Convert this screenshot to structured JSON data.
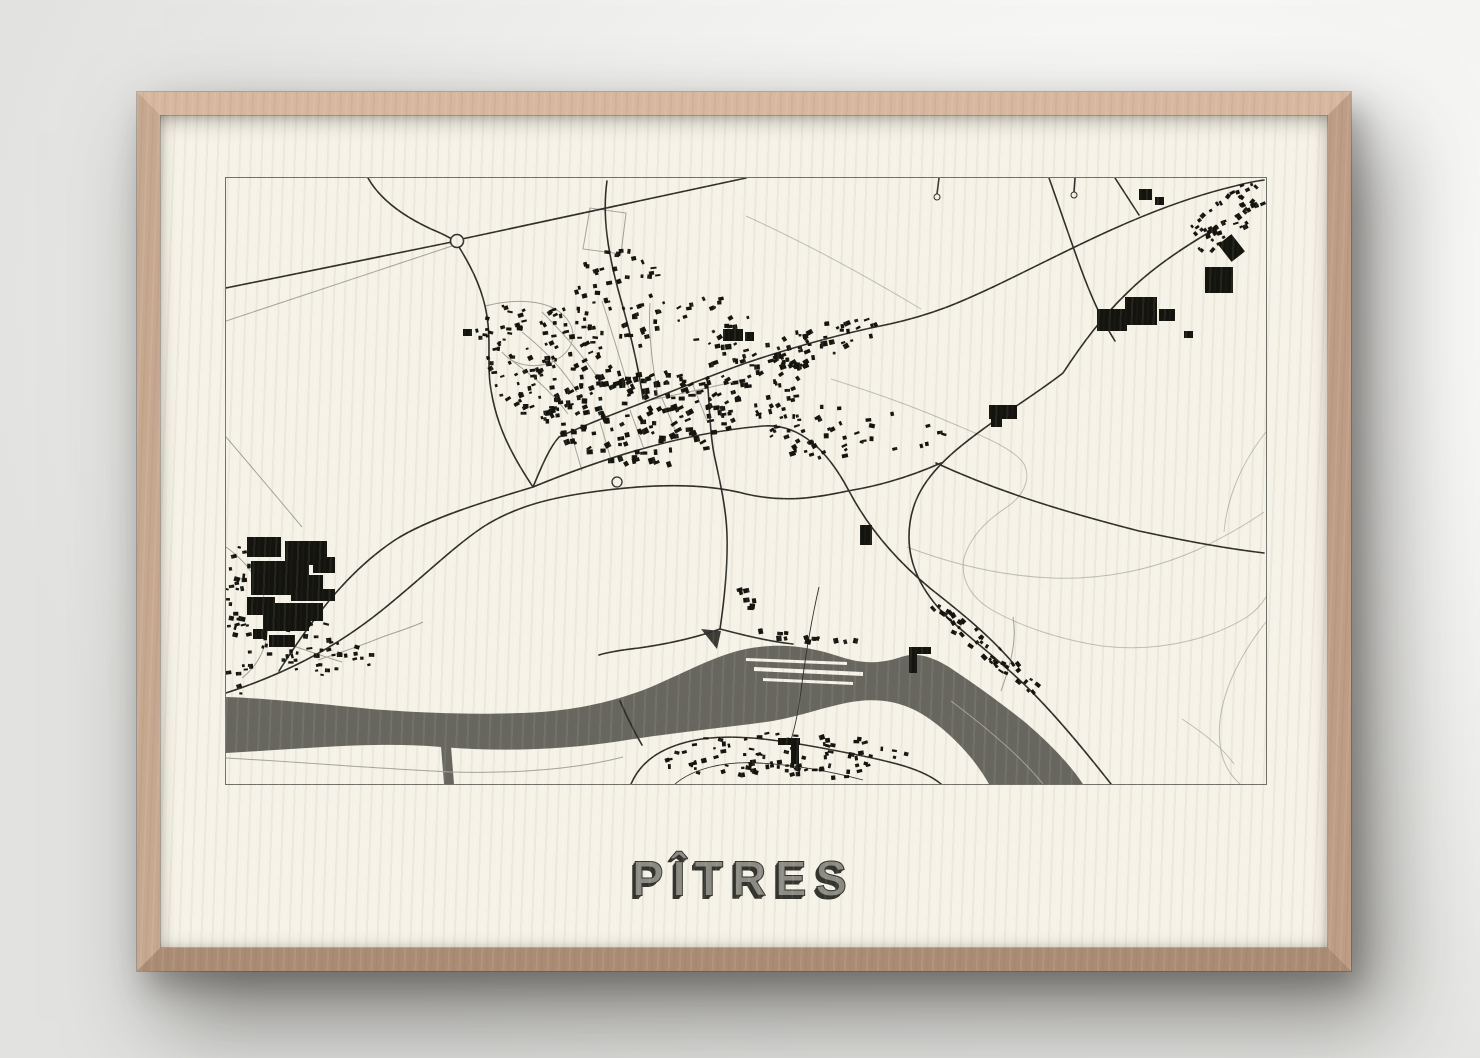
{
  "wall": {
    "center": "#ffffff",
    "mid": "#f1f1ef",
    "edge": "#e2e2e0"
  },
  "frame": {
    "wood_top": "#d6b79f",
    "wood_left": "#c6a88f",
    "wood_right": "#bd9d85",
    "wood_bottom": "#aa8c74"
  },
  "poster": {
    "background": "#f5f2e7",
    "title": "PÎTRES",
    "title_fill": "#8c8c85",
    "title_outline": "#34342f",
    "title_shadow": "#34342f"
  },
  "map": {
    "viewBox": "225 177 1040 606",
    "land_color": "#f5f2e7",
    "water_color": "#67675f",
    "border_color": "#70706a",
    "road_major_color": "#2e2e29",
    "road_minor_color": "#a3a399",
    "terrain_color": "#bdbdb2",
    "building_color": "#14140f",
    "structure_color": "#3b3b36",
    "water": {
      "main": "M225,696 C260,697 310,702 370,708 C430,713 490,714 540,711 C580,708 615,700 650,686 C685,671 715,654 745,648 C775,642 805,644 840,656 C862,663 880,663 900,656 C915,651 930,655 948,666 C975,684 1000,702 1025,722 C1048,742 1068,762 1082,783 L988,783 C975,760 955,737 930,719 C908,703 885,697 858,700 C830,703 800,716 765,721 C720,727 670,732 620,740 C560,749 500,751 440,746 C375,740 300,748 225,752 Z",
      "canal": "M439,733 L449,733 L453,783 L443,783 Z",
      "wedge": "M700,628 L720,630 L716,648 Z",
      "islands": [
        "M745,657 L846,661 L846,664 L745,660 Z",
        "M753,666 L862,671 L862,675 L753,670 Z",
        "M762,677 L852,681 L852,684 L762,680 Z"
      ]
    },
    "roads_major": [
      "M225,287 L451,241",
      "M461,238 L745,177",
      "M367,177 C380,200 404,216 430,228 C442,233 448,236 452,239",
      "M458,246 C469,264 479,283 484,305 C491,335 486,358 489,382 C492,406 499,428 510,449 C517,463 524,474 532,486",
      "M278,670 C318,607 352,567 394,539 C428,517 492,498 532,486",
      "M532,486 C542,462 549,446 558,436 C590,421 626,408 654,397 C684,385 714,373 745,362 C792,346 844,332 884,324 C932,314 962,300 992,286",
      "M992,286 C1034,266 1072,246 1110,229 C1152,210 1196,194 1234,185 C1245,182 1256,180 1263,179",
      "M606,180 C601,215 607,252 618,292 C628,327 637,362 642,398",
      "M706,378 C709,402 708,427 713,453 C719,481 725,506 726,533 C727,566 723,601 719,628",
      "M719,628 C694,637 666,643 638,647 C620,649 608,651 598,654",
      "M719,628 C742,634 766,640 792,643",
      "M1207,232 C1180,248 1150,268 1126,292 C1101,316 1081,343 1062,372 C1030,397 988,421 954,450 C924,476 908,501 908,536 C908,566 923,593 946,616 C971,639 1001,661 1029,689 C1051,711 1081,746 1110,783",
      "M935,462 C1000,492 1068,512 1138,530 C1184,540 1228,548 1263,552",
      "M1048,177 C1058,205 1068,235 1080,268 C1090,295 1100,318 1114,340",
      "M1114,177 L1138,214",
      "M938,177 L936,193",
      "M1074,177 L1073,191",
      "M630,783 C640,760 660,747 690,740 C732,730 792,741 852,753 C892,761 922,768 940,783",
      "M641,744 C633,730 625,714 619,700",
      "M532,486 C600,458 680,432 762,425 C800,422 828,452 848,490 C868,528 896,560 930,588 C958,610 988,634 1012,662",
      "M225,692 C280,674 330,650 380,610 C420,578 452,546 482,526 C512,507 544,498 584,492 C644,483 700,481 745,493 C792,504 830,493 852,489 C892,482 922,470 940,462"
    ],
    "roads_thin": [
      "M818,586 C812,612 806,645 801,682 C798,708 794,726 790,739",
      "M674,783 C692,768 722,760 757,762 C797,764 832,771 862,779"
    ],
    "roads_minor": [
      "M225,320 L451,245",
      "M484,305 C520,296 552,300 566,318 C578,334 571,352 551,361 C531,369 511,363 501,351",
      "M582,248 L589,207 L625,212 L620,253 Z",
      "M570,432 L581,470",
      "M599,421 L611,462",
      "M629,409 L643,448",
      "M661,397 L677,436",
      "M692,384 L706,420",
      "M601,300 C611,331 620,361 629,391",
      "M657,395 C651,361 647,331 649,302",
      "M521,331 C541,347 561,366 576,391",
      "M506,356 C530,373 552,392 567,413",
      "M541,311 C561,331 581,353 596,376",
      "M317,659 C342,651 364,643 384,635 C402,629 414,625 422,621",
      "M281,641 C301,648 321,655 341,661",
      "M225,546 C249,563 263,586 267,613 C269,641 259,663 241,677",
      "M225,436 C255,471 281,502 301,526",
      "M225,757 C300,761 380,768 450,771 C520,773 580,767 622,756",
      "M950,700 C990,730 1022,758 1042,783",
      "M1000,690 C1010,662 1016,640 1012,616",
      "M644,400 C676,394 710,386 745,378"
    ],
    "terrain": [
      "M830,378 C868,390 906,403 941,418 C976,433 1012,446 1023,463 C1031,479 1021,496 1006,506 C986,519 969,536 963,557 C959,577 969,596 991,609 C1021,626 1061,639 1101,645 C1151,651 1206,641 1246,616 C1256,609 1262,601 1265,596",
      "M906,546 C951,563 1001,575 1051,577 C1101,579 1151,569 1196,549 C1221,537 1246,523 1263,511",
      "M1265,431 C1241,461 1226,496 1223,531",
      "M1265,621 C1241,651 1223,686 1219,719 C1216,749 1223,769 1239,783",
      "M1181,718 C1201,731 1221,746 1233,763",
      "M745,215 C800,240 860,272 920,308"
    ],
    "circles": [
      {
        "x": 456,
        "y": 240,
        "r": 6.5,
        "sw": 1.6
      },
      {
        "x": 616,
        "y": 481,
        "r": 5,
        "sw": 1.3
      },
      {
        "x": 936,
        "y": 196,
        "r": 3,
        "sw": 1
      },
      {
        "x": 1073,
        "y": 194,
        "r": 3,
        "sw": 1
      }
    ],
    "large_buildings": [
      [
        246,
        536,
        34,
        20,
        0
      ],
      [
        284,
        540,
        42,
        24,
        0
      ],
      [
        250,
        560,
        58,
        34,
        0
      ],
      [
        290,
        574,
        32,
        26,
        0
      ],
      [
        312,
        556,
        22,
        16,
        0
      ],
      [
        246,
        596,
        28,
        18,
        0
      ],
      [
        262,
        602,
        46,
        28,
        0
      ],
      [
        298,
        602,
        24,
        18,
        0
      ],
      [
        268,
        634,
        26,
        12,
        0
      ],
      [
        252,
        628,
        14,
        10,
        0
      ],
      [
        318,
        588,
        16,
        12,
        0
      ],
      [
        722,
        328,
        20,
        12,
        0
      ],
      [
        744,
        331,
        9,
        9,
        0
      ],
      [
        462,
        328,
        9,
        7,
        0
      ],
      [
        988,
        404,
        28,
        14,
        0
      ],
      [
        990,
        404,
        11,
        22,
        0
      ],
      [
        859,
        524,
        12,
        20,
        0
      ],
      [
        1096,
        308,
        30,
        22,
        0
      ],
      [
        1124,
        296,
        32,
        28,
        0
      ],
      [
        1158,
        308,
        16,
        12,
        0
      ],
      [
        1183,
        330,
        9,
        7,
        0
      ],
      [
        1204,
        266,
        28,
        26,
        0
      ],
      [
        1222,
        236,
        17,
        22,
        -38
      ],
      [
        1138,
        188,
        13,
        11,
        0
      ],
      [
        1154,
        196,
        9,
        8,
        0
      ]
    ],
    "locks": [
      [
        908,
        646,
        22,
        7,
        0
      ],
      [
        908,
        646,
        8,
        26,
        0
      ],
      [
        777,
        737,
        22,
        7,
        0
      ],
      [
        790,
        737,
        8,
        26,
        0
      ]
    ],
    "clusters": [
      {
        "cx": 640,
        "cy": 418,
        "rx": 95,
        "ry": 48,
        "n": 150,
        "s": 4.2,
        "rot": -15,
        "skew": 0,
        "seed": 11
      },
      {
        "cx": 548,
        "cy": 362,
        "rx": 62,
        "ry": 58,
        "n": 110,
        "s": 3.4,
        "rot": -15,
        "skew": 0,
        "seed": 22
      },
      {
        "cx": 618,
        "cy": 300,
        "rx": 48,
        "ry": 52,
        "n": 60,
        "s": 3.4,
        "rot": -10,
        "skew": 0,
        "seed": 33
      },
      {
        "cx": 742,
        "cy": 382,
        "rx": 58,
        "ry": 38,
        "n": 70,
        "s": 3.8,
        "rot": -18,
        "skew": 0,
        "seed": 44
      },
      {
        "cx": 812,
        "cy": 344,
        "rx": 66,
        "ry": 20,
        "n": 55,
        "s": 3.8,
        "rot": -15,
        "skew": -0.27,
        "seed": 55
      },
      {
        "cx": 822,
        "cy": 432,
        "rx": 52,
        "ry": 30,
        "n": 40,
        "s": 3.6,
        "rot": -15,
        "skew": 0,
        "seed": 66
      },
      {
        "cx": 318,
        "cy": 648,
        "rx": 58,
        "ry": 26,
        "n": 45,
        "s": 3.4,
        "rot": 0,
        "skew": 0.1,
        "seed": 77
      },
      {
        "cx": 238,
        "cy": 622,
        "rx": 16,
        "ry": 78,
        "n": 40,
        "s": 3.4,
        "rot": 0,
        "skew": 0,
        "seed": 88
      },
      {
        "cx": 782,
        "cy": 756,
        "rx": 125,
        "ry": 24,
        "n": 95,
        "s": 3.4,
        "rot": 0,
        "skew": 0,
        "seed": 99
      },
      {
        "cx": 988,
        "cy": 650,
        "rx": 58,
        "ry": 12,
        "n": 48,
        "s": 3.4,
        "rot": 41,
        "skew": 0.8,
        "seed": 111
      },
      {
        "cx": 1224,
        "cy": 218,
        "rx": 40,
        "ry": 26,
        "n": 55,
        "s": 3.4,
        "rot": -35,
        "skew": -0.6,
        "seed": 122
      },
      {
        "cx": 798,
        "cy": 636,
        "rx": 60,
        "ry": 5,
        "n": 14,
        "s": 4.0,
        "rot": 0,
        "skew": 0.05,
        "seed": 133
      },
      {
        "cx": 900,
        "cy": 440,
        "rx": 45,
        "ry": 35,
        "n": 10,
        "s": 3.4,
        "rot": 0,
        "skew": 0,
        "seed": 144
      },
      {
        "cx": 750,
        "cy": 598,
        "rx": 18,
        "ry": 14,
        "n": 8,
        "s": 3.6,
        "rot": 0,
        "skew": 0,
        "seed": 155
      },
      {
        "cx": 505,
        "cy": 330,
        "rx": 30,
        "ry": 28,
        "n": 18,
        "s": 3.0,
        "rot": 0,
        "skew": 0,
        "seed": 166
      },
      {
        "cx": 710,
        "cy": 322,
        "rx": 40,
        "ry": 30,
        "n": 22,
        "s": 3.2,
        "rot": -15,
        "skew": 0,
        "seed": 177
      }
    ]
  }
}
